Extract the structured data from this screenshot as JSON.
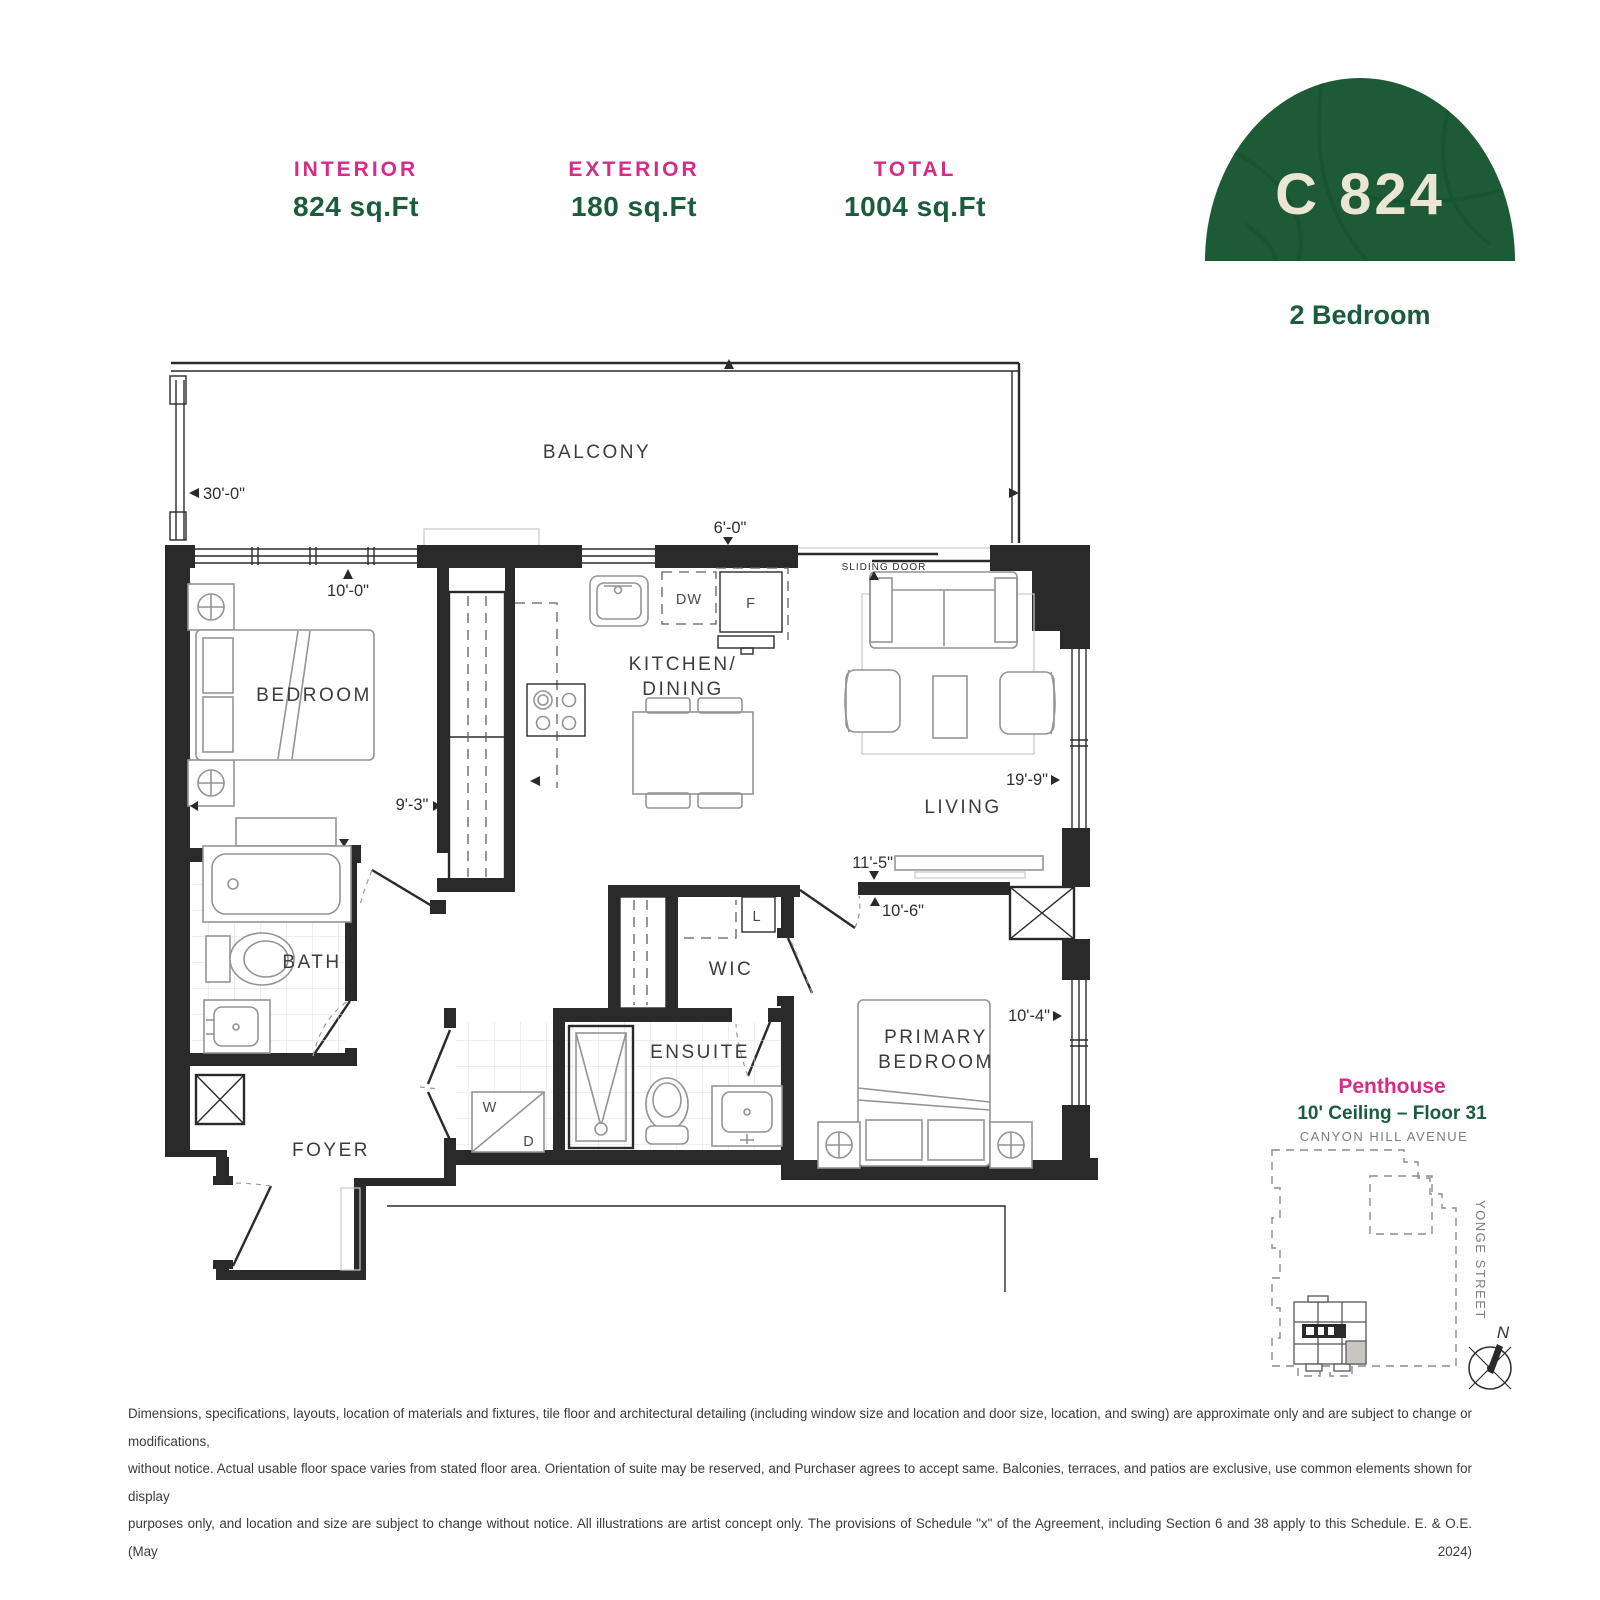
{
  "header": {
    "stats": [
      {
        "label": "INTERIOR",
        "value": "824 sq.Ft"
      },
      {
        "label": "EXTERIOR",
        "value": "180 sq.Ft"
      },
      {
        "label": "TOTAL",
        "value": "1004 sq.Ft"
      }
    ],
    "unit_code": "C 824",
    "unit_type": "2 Bedroom"
  },
  "plan": {
    "rooms": {
      "balcony": "BALCONY",
      "bedroom": "BEDROOM",
      "kitchen_line1": "KITCHEN/",
      "kitchen_line2": "DINING",
      "living": "LIVING",
      "bath": "BATH",
      "wic": "WIC",
      "ensuite": "ENSUITE",
      "primary_line1": "PRIMARY",
      "primary_line2": "BEDROOM",
      "foyer": "FOYER"
    },
    "dims": {
      "balcony_width": "30'-0\"",
      "kitchen": "6'-0\"",
      "bedroom_depth": "10'-0\"",
      "bedroom_width": "9'-3\"",
      "living_depth": "19'-9\"",
      "living_width": "11'-5\"",
      "primary_width": "10'-6\"",
      "primary_depth": "10'-4\""
    },
    "fixtures": {
      "sliding_door": "SLIDING DOOR",
      "dishwasher": "DW",
      "fridge": "F",
      "linen": "L",
      "washer": "W",
      "dryer": "D"
    }
  },
  "keyplan": {
    "title": "Penthouse",
    "subtitle": "10' Ceiling – Floor 31",
    "street_top": "CANYON HILL AVENUE",
    "street_right": "YONGE STREET",
    "north": "N"
  },
  "disclaimer": {
    "line1": "Dimensions, specifications, layouts, location of materials and fixtures, tile floor and architectural detailing (including window size and location and door size, location, and swing) are approximate only and are subject to change or modifications,",
    "line2": "without notice. Actual usable floor space varies from stated floor area. Orientation of suite may be reserved, and Purchaser agrees to accept same. Balconies, terraces, and patios are exclusive, use common elements shown for display",
    "line3": "purposes only, and location and size are subject to change without notice. All illustrations are artist concept only. The provisions of Schedule \"x\" of the Agreement, including Section 6 and 38 apply to this Schedule. E. & O.E. (May 2024)"
  },
  "colors": {
    "pink": "#D62C87",
    "green": "#1A5C3B",
    "badge_green": "#1D5B36",
    "badge_pattern": "#17522F",
    "cream": "#EAE5D4",
    "plan_line": "#2a2a2a"
  }
}
